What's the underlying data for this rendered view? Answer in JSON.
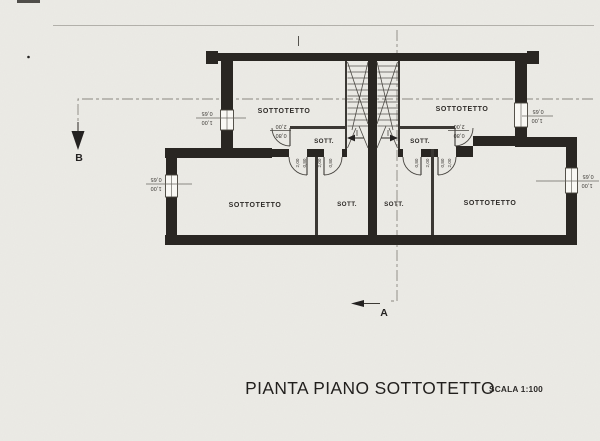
{
  "document": {
    "title": "PIANTA PIANO SOTTOTETTO",
    "scale": "SCALA 1:100"
  },
  "sections": {
    "a": "A",
    "b": "B"
  },
  "rooms": {
    "upper_left": "SOTTOTETTO",
    "upper_right": "SOTTOTETTO",
    "lower_left": "SOTTOTETTO",
    "lower_right": "SOTTOTETTO",
    "hall_left": "SOTT.",
    "hall_right": "SOTT.",
    "small_left": "SOTT.",
    "small_right": "SOTT."
  },
  "dimensions": {
    "window_width": "0,65",
    "window_sill": "1,00",
    "door_height": "2,00",
    "door_width": "0,80"
  },
  "colors": {
    "paper": "#ecebe6",
    "wall": "#282521",
    "line": "#3a3733",
    "section_line": "#8b8880"
  }
}
